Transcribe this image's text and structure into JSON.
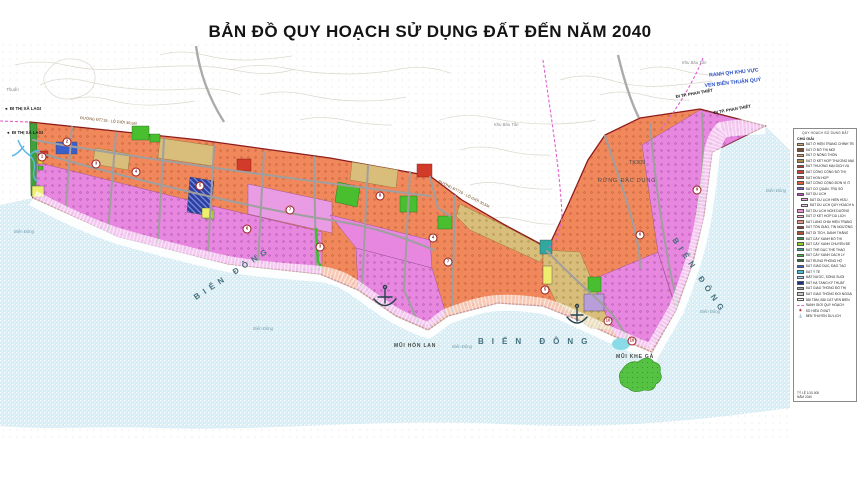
{
  "title": "BẢN ĐỒ QUY HOẠCH SỬ DỤNG ĐẤT ĐẾN NĂM 2040",
  "colors": {
    "sea": "#D6EDF5",
    "sand": "#EFD9A2",
    "coast_road_yellow": "#F6C64E",
    "coast_road_red": "#C9302C",
    "residential_orange": "#F0885C",
    "tourism_pink": "#E887E0",
    "mixed_khaki": "#D9BD7B",
    "park_green": "#49BE2E",
    "boundary_dark_red": "#8C1A1A",
    "planning_dash_pink": "#E060D0",
    "boundary_label_blue": "#2B50C8"
  },
  "map": {
    "labels": {
      "sea_big": "BIỂN ĐÔNG",
      "sea_small": "Biển Đông",
      "cape_hon_lan": "MŨI HÒN LAN",
      "cape_khe_ga": "MŨI KHE GÀ",
      "forest": "RỪNG ĐẶC DỤNG",
      "forest_code": "TK309",
      "boundary_line1": "RANH QH KHU VỰC",
      "boundary_line2": "VEN BIỂN THUẬN QUÝ",
      "dir_lagi": "ĐI THỊ XÃ LAGI",
      "dir_lagi_arrow": "◄",
      "dir_phan_thiet": "ĐI TP. PHAN THIẾT",
      "road_dt719": "ĐƯỜNG ĐT719 - LỘ GIỚI 30,5M",
      "khu_bau_tan": "Khu Bàu Tân",
      "thuan": "Thuận"
    },
    "markers": [
      {
        "n": "1",
        "x": 42,
        "y": 157
      },
      {
        "n": "2",
        "x": 67,
        "y": 142
      },
      {
        "n": "3",
        "x": 96,
        "y": 164
      },
      {
        "n": "4",
        "x": 136,
        "y": 172
      },
      {
        "n": "5",
        "x": 200,
        "y": 186
      },
      {
        "n": "6",
        "x": 247,
        "y": 229
      },
      {
        "n": "7",
        "x": 290,
        "y": 210
      },
      {
        "n": "3",
        "x": 320,
        "y": 247
      },
      {
        "n": "8",
        "x": 380,
        "y": 196
      },
      {
        "n": "4",
        "x": 433,
        "y": 238
      },
      {
        "n": "7",
        "x": 448,
        "y": 262
      },
      {
        "n": "5",
        "x": 545,
        "y": 290
      },
      {
        "n": "6",
        "x": 640,
        "y": 235
      },
      {
        "n": "9",
        "x": 697,
        "y": 190
      },
      {
        "n": "10",
        "x": 608,
        "y": 321
      },
      {
        "n": "10",
        "x": 632,
        "y": 341
      }
    ]
  },
  "legend": {
    "heading": "QUY HOẠCH SỬ DỤNG ĐẤT",
    "title": "CHÚ GIẢI",
    "items": [
      {
        "label": "ĐẤT Ở HIỆN TRẠNG CHỈNH TRANG",
        "color": "#D8A878"
      },
      {
        "label": "ĐẤT Ở ĐÔ THỊ MỚI",
        "color": "#7B4B28"
      },
      {
        "label": "ĐẤT Ở NÔNG THÔN",
        "color": "#E09A5E"
      },
      {
        "label": "ĐẤT Ở KẾT HỢP THƯƠNG MẠI DỊCH VỤ",
        "color": "#A8904A"
      },
      {
        "label": "ĐẤT THƯƠNG MẠI DỊCH VỤ",
        "color": "#C0392B"
      },
      {
        "label": "ĐẤT CÔNG CỘNG ĐÔ THỊ",
        "color": "#D04030"
      },
      {
        "label": "ĐẤT HỖN HỢP",
        "color": "#E05858"
      },
      {
        "label": "ĐẤT CÔNG CỘNG ĐƠN VỊ Ở",
        "color": "#E06038"
      },
      {
        "label": "ĐẤT CƠ QUAN, TRỤ SỞ",
        "color": "#7C5CD6"
      },
      {
        "label": "ĐẤT DU LỊCH",
        "color": "#C83ED2"
      },
      {
        "label": "ĐẤT DU LỊCH HIỆN HỮU",
        "color": "#EFAAEB",
        "style": "sub"
      },
      {
        "label": "ĐẤT DU LỊCH QUY HOẠCH MỚI",
        "color": "#F5C9F3",
        "style": "sub"
      },
      {
        "label": "ĐẤT DU LỊCH NGHỈ DƯỠNG",
        "color": "#EE8FD8"
      },
      {
        "label": "ĐẤT Ở KẾT HỢP DU LỊCH",
        "color": "#F2AEC8"
      },
      {
        "label": "ĐẤT LÀNG CHÀI HIỆN TRẠNG",
        "color": "#E89078"
      },
      {
        "label": "ĐẤT TÔN GIÁO, TÍN NGƯỠNG",
        "color": "#9E3A2A"
      },
      {
        "label": "ĐẤT DI TÍCH, DANH THẮNG",
        "color": "#B05038"
      },
      {
        "label": "ĐẤT CÂY XANH ĐÔ THỊ",
        "color": "#2E9E3E"
      },
      {
        "label": "ĐẤT CÂY XANH CHUYÊN ĐỀ",
        "color": "#8CD426"
      },
      {
        "label": "ĐẤT THỂ DỤC THỂ THAO",
        "color": "#2FB0A0"
      },
      {
        "label": "ĐẤT CÂY XANH CÁCH LY",
        "color": "#4CB848"
      },
      {
        "label": "ĐẤT RỪNG PHÒNG HỘ",
        "color": "#1E7A2E"
      },
      {
        "label": "ĐẤT GIÁO DỤC, ĐÀO TẠO",
        "color": "#3A5FCC"
      },
      {
        "label": "ĐẤT Y TẾ",
        "color": "#38C0DC"
      },
      {
        "label": "MẶT NƯỚC, SÔNG SUỐI",
        "color": "#A8D8EC"
      },
      {
        "label": "ĐẤT HẠ TẦNG KỸ THUẬT",
        "color": "#1A2E8C"
      },
      {
        "label": "ĐẤT GIAO THÔNG ĐÔ THỊ",
        "color": "#9E9E9E"
      },
      {
        "label": "ĐẤT GIAO THÔNG ĐỐI NGOẠI",
        "color": "#C8C8C8"
      },
      {
        "label": "BÃI TẮM, BÃI CÁT VEN BIỂN",
        "color": "#F2E4B8",
        "style": "hatch"
      },
      {
        "label": "RANH GIỚI QUY HOẠCH",
        "color": "#E060D0",
        "style": "dash"
      },
      {
        "label": "SỐ HIỆU Ô ĐẤT",
        "color": "#9B1C1C",
        "style": "circle"
      },
      {
        "label": "BẾN THUYỀN DU LỊCH",
        "color": "#27424E",
        "style": "anchor"
      }
    ],
    "note1": "TỶ LỆ 1/10.000",
    "note2": "NĂM 2040"
  }
}
